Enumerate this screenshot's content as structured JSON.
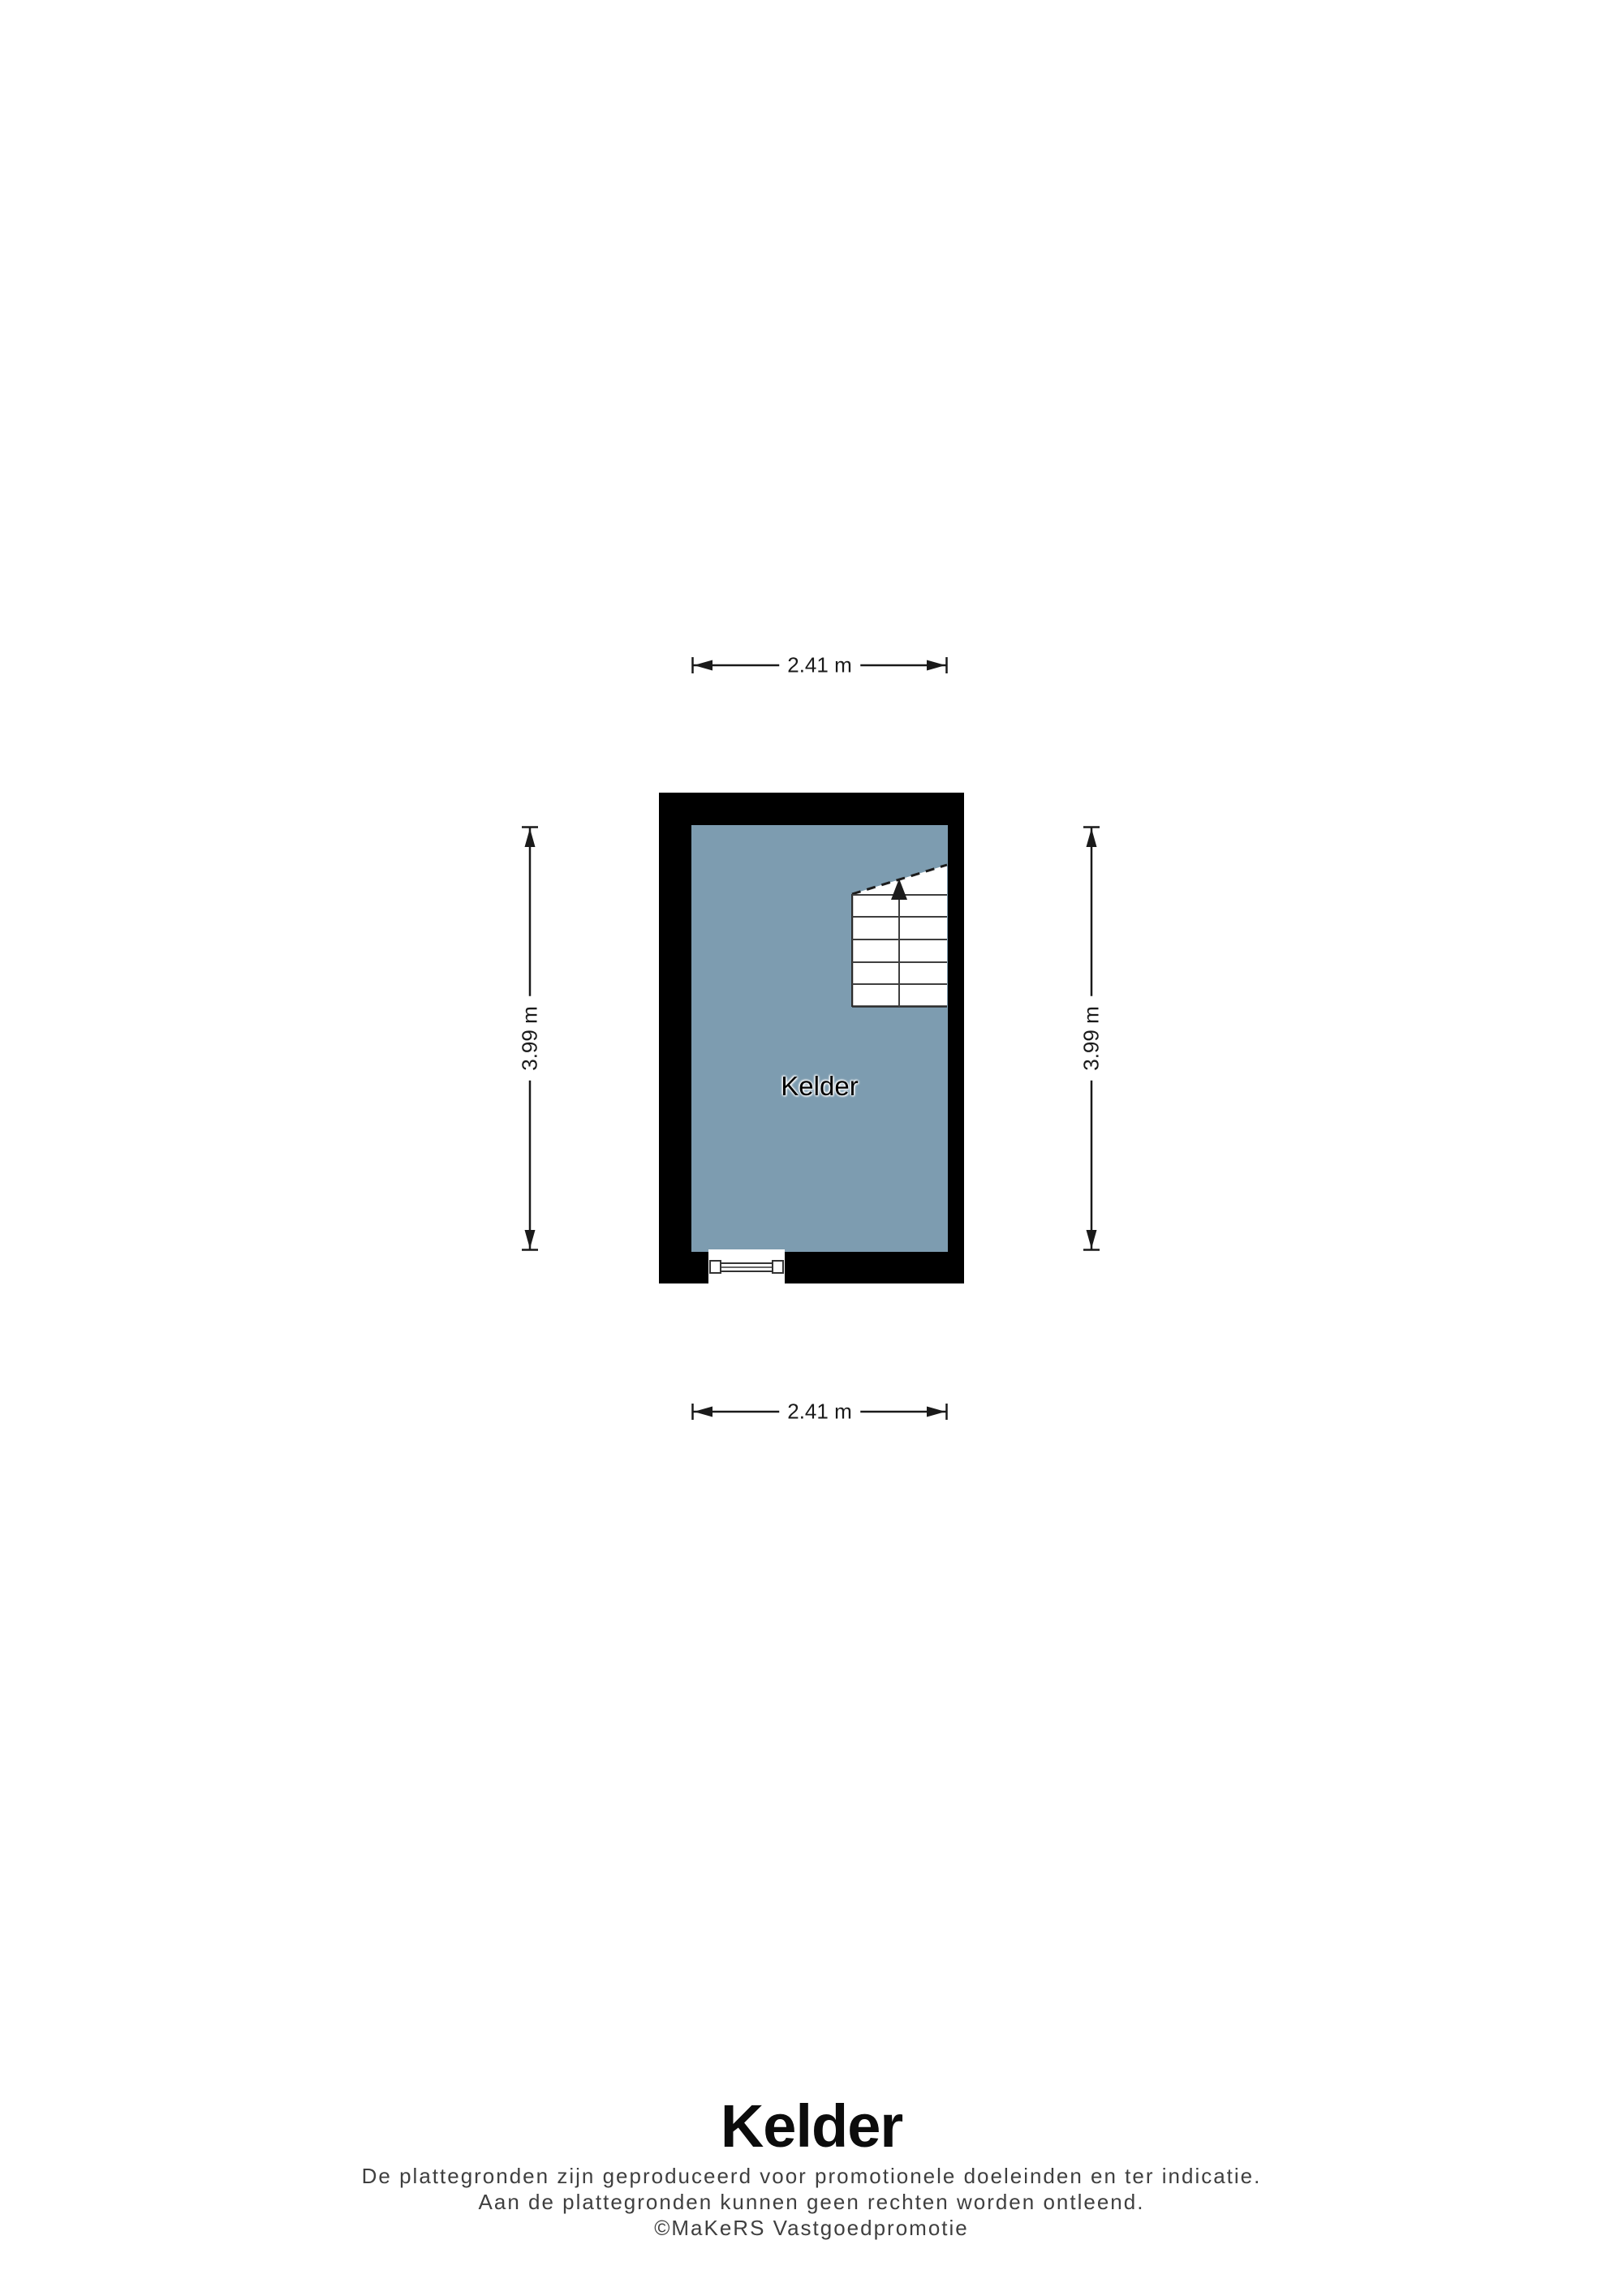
{
  "plan": {
    "room_label": "Kelder",
    "dimensions": {
      "top": "2.41 m",
      "bottom": "2.41 m",
      "left": "3.99 m",
      "right": "3.99 m"
    }
  },
  "footer": {
    "title": "Kelder",
    "disclaimer_line1": "De plattegronden zijn geproduceerd voor promotionele doeleinden en ter indicatie.",
    "disclaimer_line2": "Aan de plattegronden kunnen geen rechten worden ontleend.",
    "disclaimer_line3": "©MaKeRS Vastgoedpromotie"
  },
  "colors": {
    "wall": "#000000",
    "floor": "#7d9cb0",
    "stair_line": "#3f3f3f",
    "dimension": "#1a1a1a",
    "disclaimer_text": "#3f3f3f"
  }
}
